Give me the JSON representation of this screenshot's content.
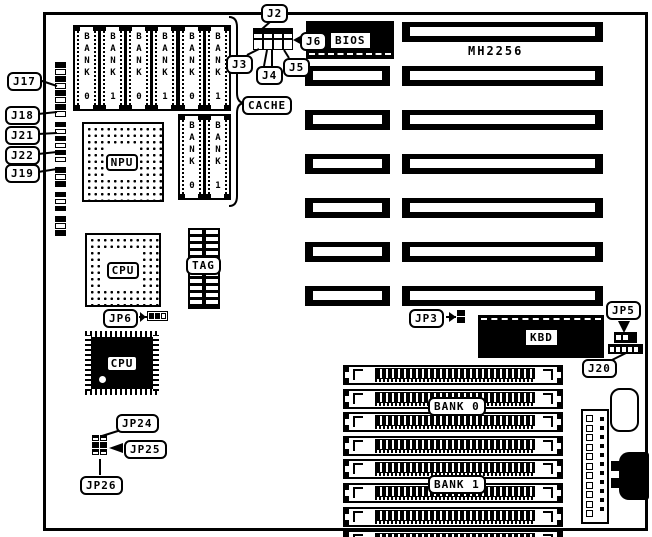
{
  "labels": {
    "model": "MH2256",
    "cache": "CACHE",
    "bios": "BIOS",
    "kbd": "KBD",
    "npu": "NPU",
    "cpu_socket": "CPU",
    "cpu_qfp": "CPU",
    "tag": "TAG"
  },
  "memory": {
    "cache_row1": [
      "BANK 0",
      "BANK 1",
      "BANK 0",
      "BANK 1",
      "BANK 0",
      "BANK 1"
    ],
    "cache_row2": [
      "BANK 0",
      "BANK 1"
    ],
    "simm_bank0": "BANK 0",
    "simm_bank1": "BANK 1"
  },
  "connectors": {
    "left": [
      "J17",
      "J18",
      "J21",
      "J22",
      "J19"
    ],
    "top": {
      "j2": "J2",
      "j6": "J6",
      "j3": "J3",
      "j4": "J4",
      "j5": "J5"
    },
    "jp6": "JP6",
    "jp3": "JP3",
    "jp5": "JP5",
    "j20": "J20",
    "jp24": "JP24",
    "jp25": "JP25",
    "jp26": "JP26"
  }
}
